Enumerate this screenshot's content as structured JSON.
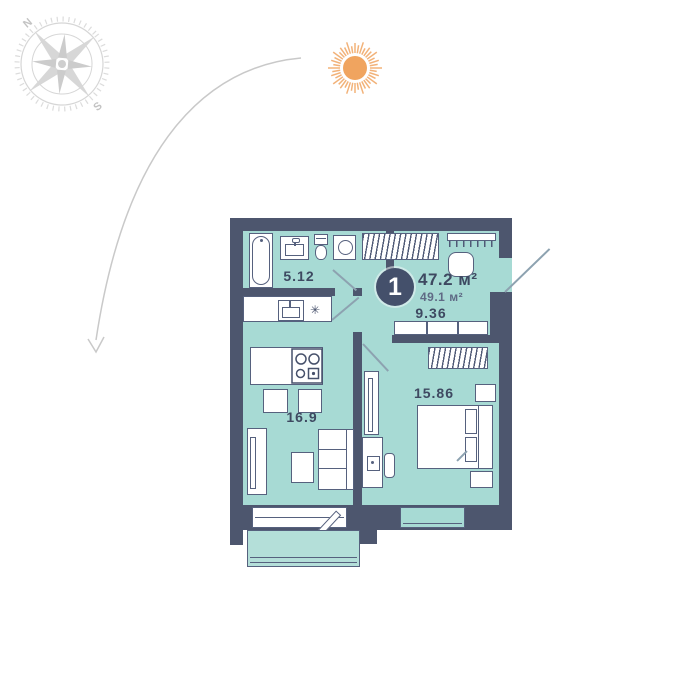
{
  "compass": {
    "north": "N",
    "south": "S"
  },
  "plan": {
    "badge": "1",
    "area_living": "47.2 м²",
    "area_total": "49.1 м²",
    "rooms": {
      "bathroom": {
        "area": "5.12"
      },
      "hallway": {
        "area": "9.36"
      },
      "kitchen_living": {
        "area": "16.9"
      },
      "bedroom": {
        "area": "15.86"
      },
      "balcony": {
        "area": "3.63"
      }
    },
    "fridge_symbol": "✳"
  },
  "colors": {
    "wall": "#4d566e",
    "room_fill": "#a7dad4",
    "balcony_fill": "#b4dfd9",
    "text": "#3e4961",
    "sun": "#f0a45f",
    "compass_gray": "#d4d4d4"
  }
}
